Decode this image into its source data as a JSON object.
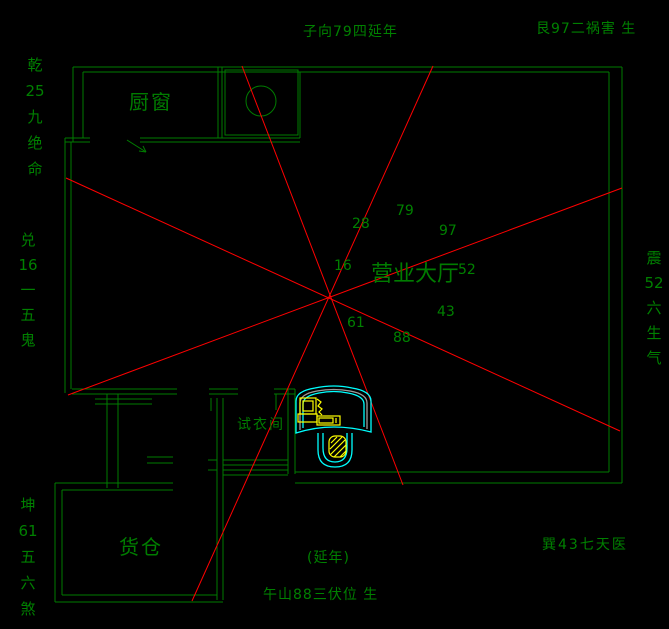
{
  "colors": {
    "background": "#000000",
    "wall": "#007c00",
    "text": "#008000",
    "compass_line": "#ff0000",
    "furniture": "#00ffff",
    "equipment": "#ffff00",
    "desk_trim": "#9c9c9c"
  },
  "compass": {
    "north_label": "子向79四延年",
    "northeast_label": "艮97二祸害 生",
    "northwest_label": "乾\n25\n九\n绝\n命",
    "west_label": "兑\n16\n一\n五\n鬼",
    "southwest_label": "坤\n61\n五\n六\n煞",
    "east_label": "震\n52\n六\n生\n气",
    "southeast_label": "巽43七天医",
    "south_note": "(延年)",
    "south_label": "午山88三伏位 生"
  },
  "star_numbers": {
    "nw": "28",
    "n": "79",
    "ne": "97",
    "w": "16",
    "e": "52",
    "sw": "61",
    "se": "43",
    "s": "88"
  },
  "rooms": {
    "kitchen": "厨窗",
    "hall": "营业大厅",
    "fitting_room": "试衣间",
    "warehouse": "货仓"
  }
}
